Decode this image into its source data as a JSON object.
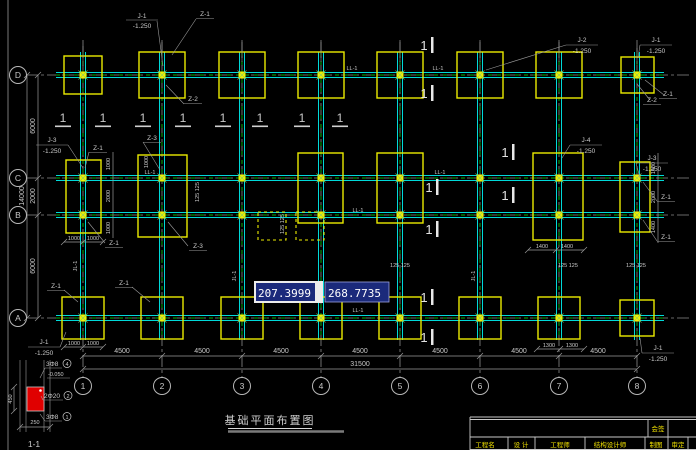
{
  "viewport": {
    "coordinate_input": {
      "x_value": "207.3999",
      "y_value": "268.7735"
    }
  },
  "drawing": {
    "title": "基础平面布置图",
    "axes": {
      "rows": [
        "D",
        "C",
        "B",
        "A"
      ],
      "cols": [
        "1",
        "2",
        "3",
        "4",
        "5",
        "6",
        "7",
        "8"
      ]
    },
    "dims": {
      "bay": "4500",
      "total_width": "31500",
      "span_dc": "6000",
      "span_cb": "2000",
      "span_ba": "6000",
      "total_height": "14000",
      "d1000": "1000",
      "d1300": "1300",
      "d1400": "1400",
      "d2000": "2000",
      "d125": "125 125",
      "d450": "450",
      "d250": "250"
    },
    "tags": {
      "j1": "J-1",
      "j2": "J-2",
      "j3": "J-3",
      "j4": "J-4",
      "z1": "Z-1",
      "z2": "Z-2",
      "z3": "Z-3",
      "ll1": "LL-1",
      "jl1": "JL-1",
      "elevation": "-1.250",
      "one": "1"
    },
    "detail": {
      "caption": "1-1",
      "rebar_top": "3Φ8",
      "rebar_mid": "2Φ20",
      "rebar_bottom": "3Φ8",
      "elevation": "-0.050",
      "item_top": "4",
      "item_mid": "2",
      "item_bottom": "1"
    }
  },
  "title_block": {
    "sign": "会签",
    "cells": [
      "工程名",
      "设 计",
      "工程师",
      "结构设计师",
      "制图",
      "审定"
    ]
  }
}
